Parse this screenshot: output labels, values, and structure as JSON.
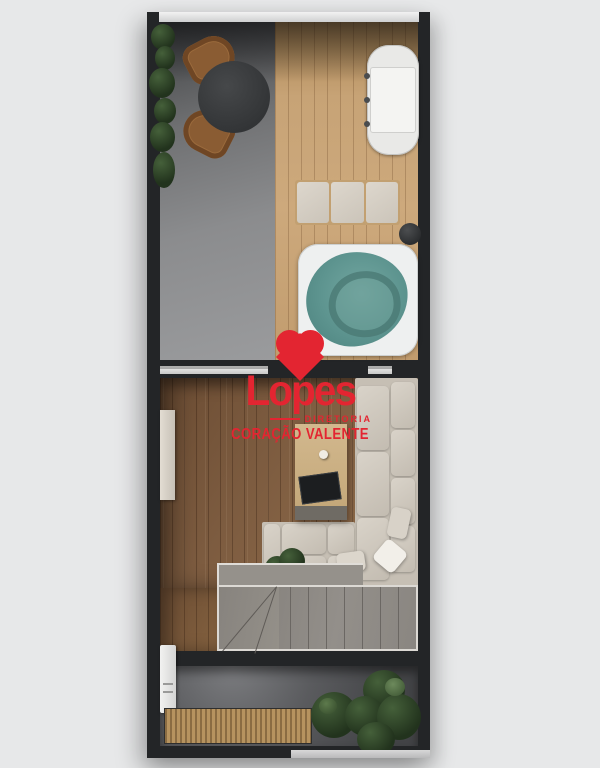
{
  "page": {
    "background": "#e7e8e9"
  },
  "watermark": {
    "brand": "Lopes",
    "subtitle": "DIRETORIA",
    "tagline": "CORAÇÃO VALENTE",
    "color": "#e32531",
    "icon": "heart-icon"
  },
  "floorplan": {
    "view": "top-down rooftop apartment render",
    "colors": {
      "wall": "#232527",
      "concrete_floor": "#8b8c8e",
      "deck_wood": "#c7a376",
      "living_wood": "#7d5c40",
      "sofa": "#cfc8bd",
      "hot_tub_water": "#5d948f",
      "stairs": "#8d8984",
      "lower_terrace": "#4c4d50",
      "bench_wood": "#b6935f",
      "plant": "#2c4430",
      "watermark_red": "#e32531"
    },
    "rooms": [
      {
        "name": "upper-terrace",
        "items": [
          "planter-vines",
          "dining-chair",
          "dining-chair",
          "round-dining-table",
          "barbecue-grill",
          "daybed-lounger",
          "side-table",
          "hot-tub"
        ]
      },
      {
        "name": "living-room",
        "items": [
          "sliding-door-track",
          "wall-shelf",
          "l-shaped-sofa",
          "throw-pillow",
          "throw-pillow",
          "throw-pillow",
          "coffee-table",
          "decor-tray",
          "mug",
          "potted-plant"
        ]
      },
      {
        "name": "staircase",
        "items": [
          "landing",
          "winder-steps",
          "straight-steps"
        ]
      },
      {
        "name": "lower-terrace",
        "items": [
          "wall-fixture",
          "slatted-bench",
          "round-potted-plant",
          "large-potted-plant"
        ]
      }
    ]
  }
}
